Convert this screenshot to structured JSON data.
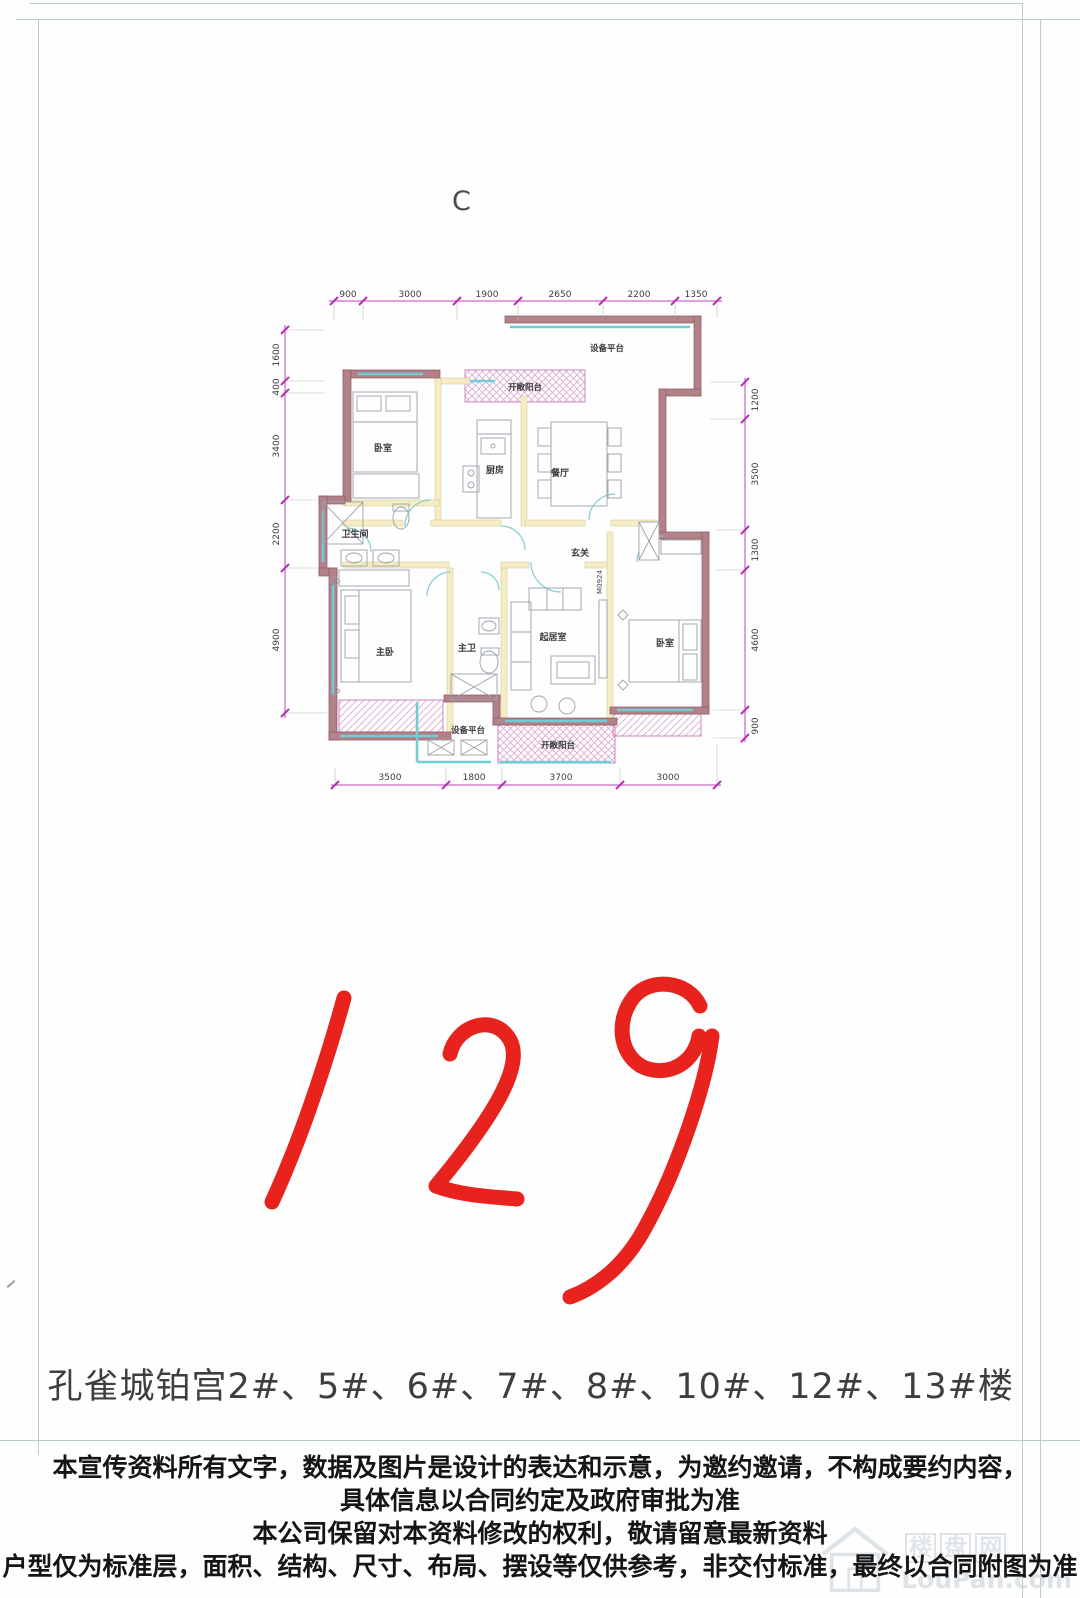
{
  "page": {
    "plan_type_label": "C",
    "big_number": "129",
    "building_line": "孔雀城铂宫2#、5#、6#、7#、8#、10#、12#、13#楼",
    "disclaimer_lines": [
      "本宣传资料所有文字，数据及图片是设计的表达和示意，为邀约邀请，不构成要约内容，",
      "具体信息以合同约定及政府审批为准",
      "本公司保留对本资料修改的权利，敬请留意最新资料",
      "户型仅为标准层，面积、结构、尺寸、布局、摆设等仅供参考，非交付标准，最终以合同附图为准"
    ],
    "watermark": {
      "chars": [
        "楼",
        "盘",
        "网"
      ],
      "domain": "LouPan.com"
    }
  },
  "plan": {
    "door_code": "M0924",
    "rooms": {
      "bedroom1": "卧室",
      "kitchen": "厨房",
      "dining": "餐厅",
      "bath": "卫生间",
      "hall": "玄关",
      "master": "主卧",
      "master_bath": "主卫",
      "living": "起居室",
      "bedroom2": "卧室"
    },
    "areas": {
      "equip_top": "设备平台",
      "balcony_top": "开敞阳台",
      "equip_bottom": "设备平台",
      "balcony_bottom": "开敞阳台"
    },
    "dims_top": [
      "900",
      "3000",
      "1900",
      "2650",
      "2200",
      "1350"
    ],
    "dims_bottom": [
      "3500",
      "1800",
      "3700",
      "3000"
    ],
    "dims_left": [
      "1600",
      "400",
      "3400",
      "2200",
      "4900"
    ],
    "dims_right": [
      "1200",
      "3500",
      "1300",
      "4600",
      "900"
    ],
    "colors": {
      "wall": "#b28189",
      "dimension": "#c043c0",
      "window": "#72ccd4",
      "accent_red": "#e8221c"
    }
  }
}
